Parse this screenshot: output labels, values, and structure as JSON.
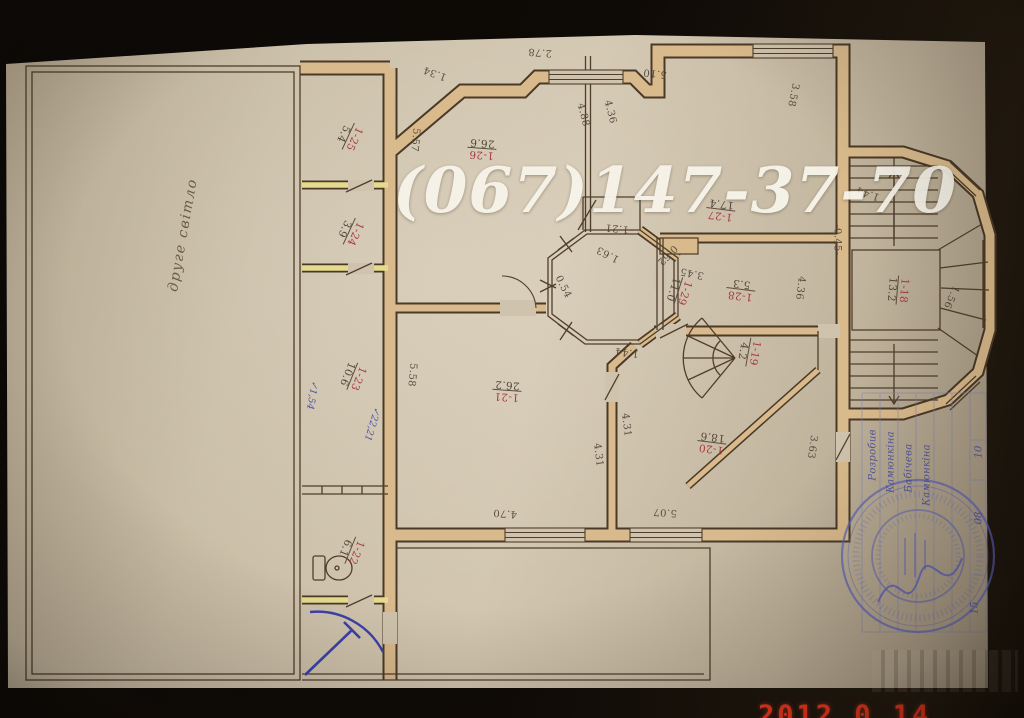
{
  "watermark": {
    "phone": "(067)147-37-70"
  },
  "camera_date": "2012  0 14",
  "plan": {
    "hall_note": "друге світло",
    "rooms": [
      {
        "number": "1-26",
        "area": "26.6"
      },
      {
        "number": "1-27",
        "area": "17.4"
      },
      {
        "number": "1-28",
        "area": "5.3"
      },
      {
        "number": "1-29",
        "area": "11.0"
      },
      {
        "number": "1-21",
        "area": "26.2"
      },
      {
        "number": "1-19",
        "area": "4.2"
      },
      {
        "number": "1-20",
        "area": "18.6"
      },
      {
        "number": "1-18",
        "area": "13.2"
      },
      {
        "number": "1-25",
        "area": "5.4"
      },
      {
        "number": "1-24",
        "area": "3.9"
      },
      {
        "number": "1-23",
        "area": "10.6"
      },
      {
        "number": "1-22",
        "area": "6.1"
      }
    ],
    "dims": [
      "2.78",
      "1.34",
      "5.57",
      "4.88",
      "4.36",
      "5.10",
      "3.58",
      "1.21",
      "1.63",
      "0.62",
      "3.45",
      "0.54",
      "4.36",
      "-0.45-",
      "1.44",
      "1.44",
      "5.58",
      "4.31",
      "4.31",
      "4.70",
      "5.07",
      "3.63",
      "1.56"
    ],
    "blue_notes": [
      "✓1,54",
      "✓22,21"
    ]
  },
  "stamp": {
    "rows": [
      "Розробив",
      "Камюнкіна",
      "Бабічева",
      "Камюнкіна"
    ],
    "cells": [
      "10",
      "08",
      "15"
    ]
  }
}
